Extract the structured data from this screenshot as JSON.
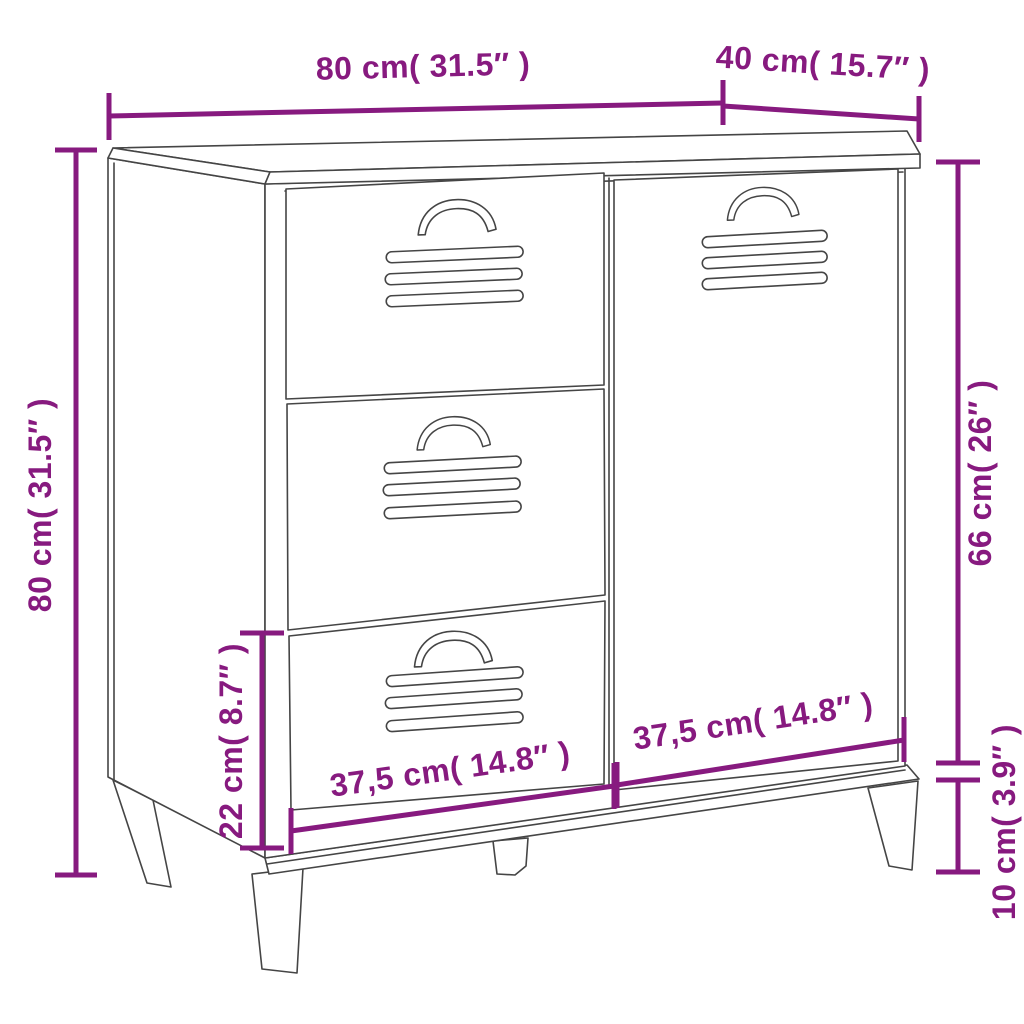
{
  "page": {
    "background": "#ffffff"
  },
  "diagram": {
    "type": "furniture-dimension-diagram",
    "colors": {
      "dimension": "#871a7f",
      "outline": "#454545",
      "background": "#ffffff"
    },
    "parts": {
      "drawers": 3,
      "doors": 1,
      "legs": 4,
      "handles": 4,
      "vent_slots_per_panel": 3
    },
    "labels": {
      "top_width": "80 cm( 31.5″ )",
      "top_depth": "40 cm( 15.7″ )",
      "left_height": "80 cm( 31.5″ )",
      "door_height": "66 cm( 26″ )",
      "leg_height": "10 cm( 3.9″ )",
      "drawer_height": "22 cm( 8.7″ )",
      "drawer_width": "37,5 cm( 14.8″ )",
      "door_width": "37,5 cm( 14.8″ )"
    }
  }
}
